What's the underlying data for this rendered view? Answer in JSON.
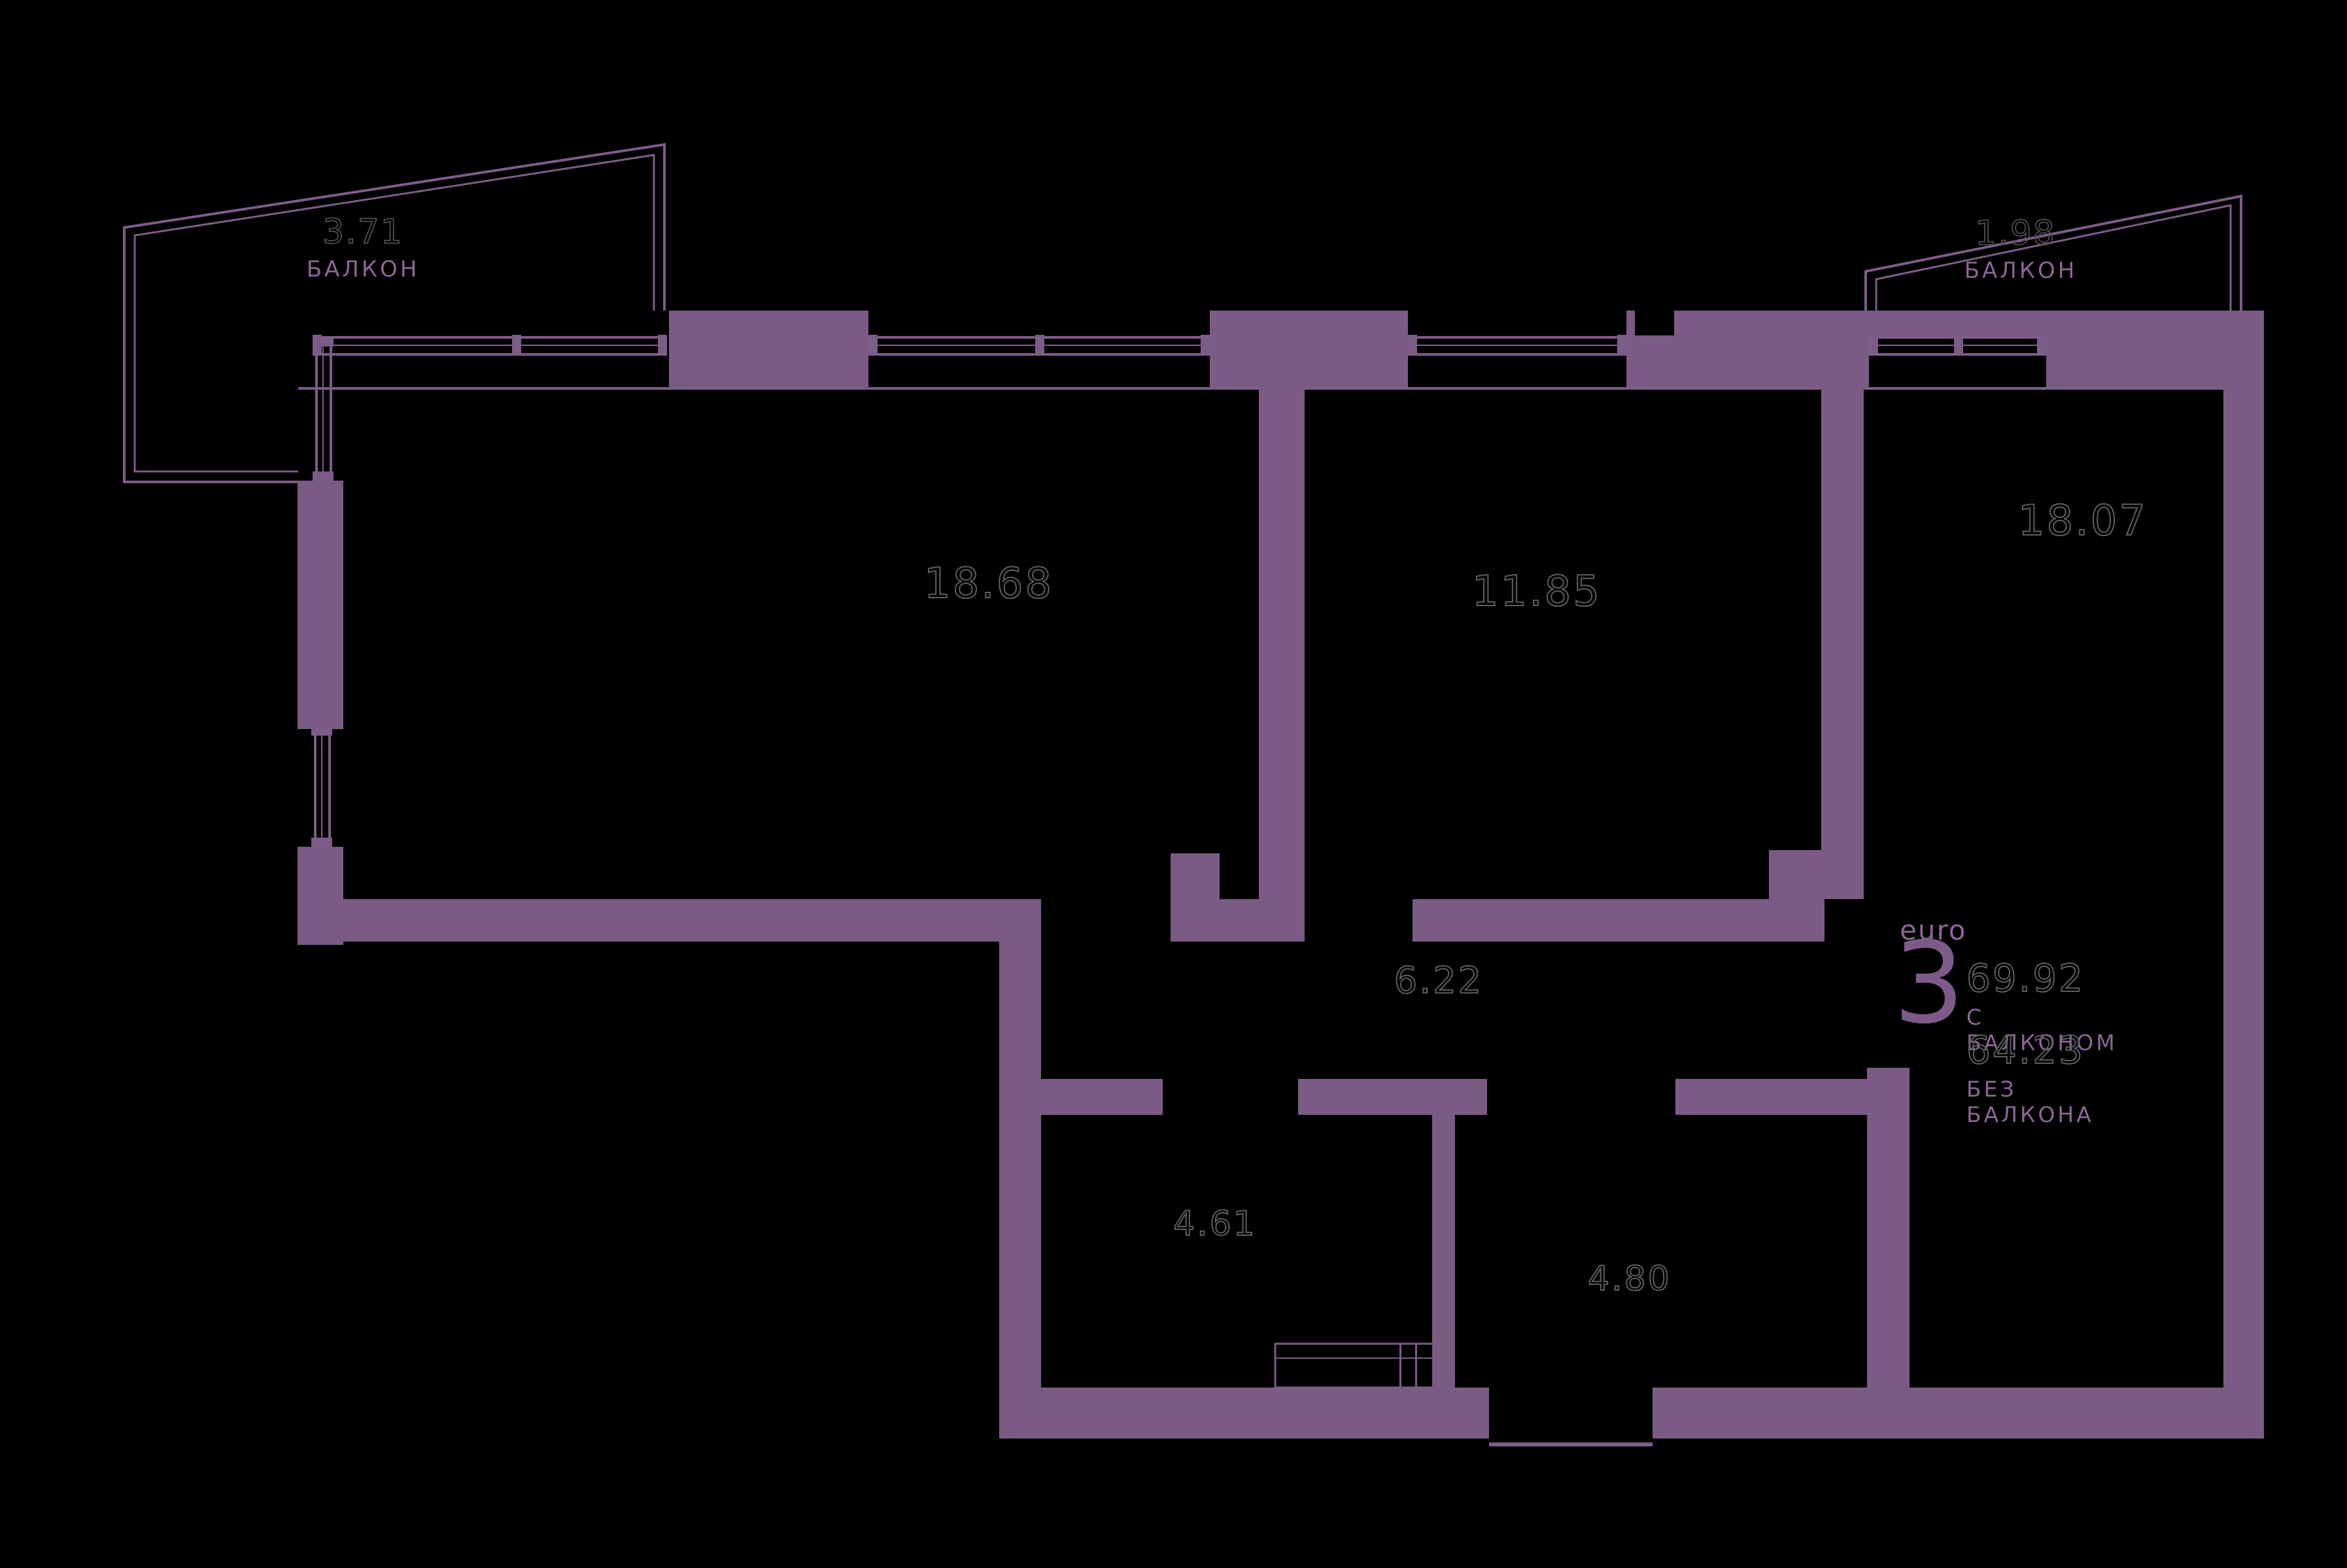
{
  "plan": {
    "rooms": [
      {
        "id": "living",
        "area": "18.68"
      },
      {
        "id": "bedroom1",
        "area": "11.85"
      },
      {
        "id": "bedroom2",
        "area": "18.07"
      },
      {
        "id": "hallway",
        "area": "6.22"
      },
      {
        "id": "bathroom",
        "area": "4.61"
      },
      {
        "id": "entry",
        "area": "4.80"
      }
    ],
    "balconies": [
      {
        "id": "balcony-left",
        "area": "3.71",
        "label": "БАЛКОН"
      },
      {
        "id": "balcony-right",
        "area": "1.98",
        "label": "БАЛКОН"
      }
    ],
    "summary": {
      "type_label": "euro",
      "rooms_count": "3",
      "area_with_balcony": "69.92",
      "with_balcony_label": "С БАЛКОНОМ",
      "area_without_balcony": "64.23",
      "without_balcony_label": "БЕЗ БАЛКОНА"
    },
    "colors": {
      "wall": "#7a5b84",
      "line": "#7c5d87",
      "background": "#000000",
      "purple_text": "#8a6694",
      "outline_text": "#5e5e5e"
    }
  }
}
